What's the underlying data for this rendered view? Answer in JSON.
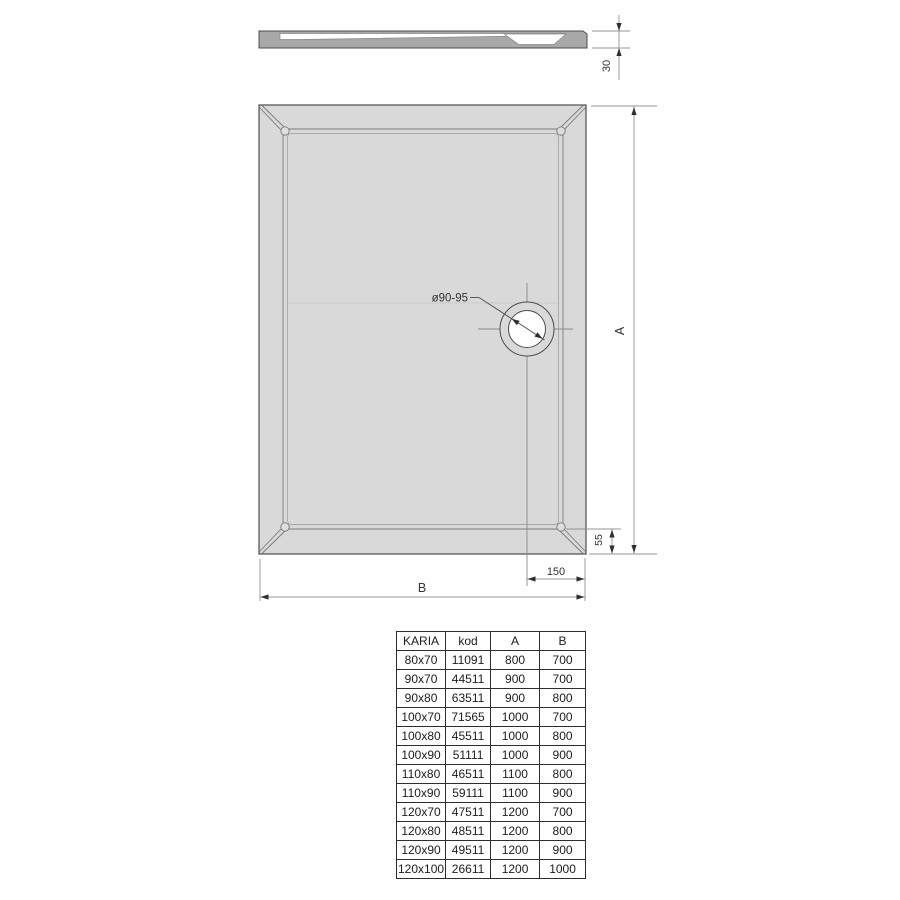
{
  "drawing": {
    "side_view": {
      "height_label": "30"
    },
    "plan_view": {
      "drain_label": "ø90-95",
      "length_label": "A",
      "width_label": "B",
      "drain_bottom_offset_label": "55",
      "drain_right_offset_label": "150"
    }
  },
  "table": {
    "headers": [
      "KARIA",
      "kod",
      "A",
      "B"
    ],
    "rows": [
      [
        "80x70",
        "11091",
        "800",
        "700"
      ],
      [
        "90x70",
        "44511",
        "900",
        "700"
      ],
      [
        "90x80",
        "63511",
        "900",
        "800"
      ],
      [
        "100x70",
        "71565",
        "1000",
        "700"
      ],
      [
        "100x80",
        "45511",
        "1000",
        "800"
      ],
      [
        "100x90",
        "51111",
        "1000",
        "900"
      ],
      [
        "110x80",
        "46511",
        "1100",
        "800"
      ],
      [
        "110x90",
        "59111",
        "1100",
        "900"
      ],
      [
        "120x70",
        "47511",
        "1200",
        "700"
      ],
      [
        "120x80",
        "48511",
        "1200",
        "800"
      ],
      [
        "120x90",
        "49511",
        "1200",
        "900"
      ],
      [
        "120x100",
        "26611",
        "1200",
        "1000"
      ]
    ]
  },
  "colors": {
    "tray_fill": "#d9d9d9",
    "profile_fill": "#a8a8a8",
    "outline": "#4d4d4d",
    "dim_line": "#949494",
    "arrow": "#2f2f2f"
  }
}
